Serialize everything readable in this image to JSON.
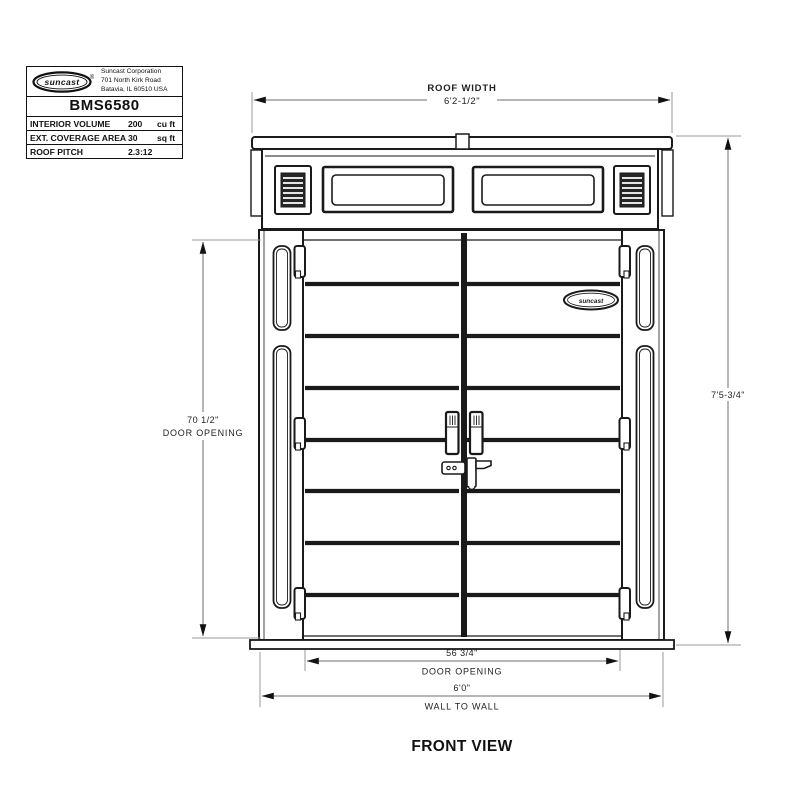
{
  "title_block": {
    "logo_text": "suncast",
    "registered_mark": "®",
    "company_lines": [
      "Suncast Corporation",
      "701 North Kirk Road",
      "Batavia, IL 60510 USA"
    ],
    "model": "BMS6580",
    "specs": [
      {
        "label": "INTERIOR VOLUME",
        "value": "200",
        "unit": "cu ft"
      },
      {
        "label": "EXT. COVERAGE AREA",
        "value": "30",
        "unit": "sq ft"
      },
      {
        "label": "ROOF PITCH",
        "value": "2.3:12",
        "unit": ""
      }
    ]
  },
  "drawing": {
    "door_badge": "suncast",
    "view_label": "FRONT VIEW",
    "dims": {
      "roof_width_label": "ROOF WIDTH",
      "roof_width_value": "6'2-1/2\"",
      "height_value": "7'5-3/4\"",
      "door_height_value": "70 1/2\"",
      "door_height_label": "DOOR OPENING",
      "door_width_value": "56 3/4\"",
      "door_width_label": "DOOR OPENING",
      "wall_value": "6'0\"",
      "wall_label": "WALL TO WALL"
    },
    "colors": {
      "line": "#1a1a1a",
      "dim_line": "#6e6e6e",
      "ext_line": "#9a9a9a"
    }
  }
}
